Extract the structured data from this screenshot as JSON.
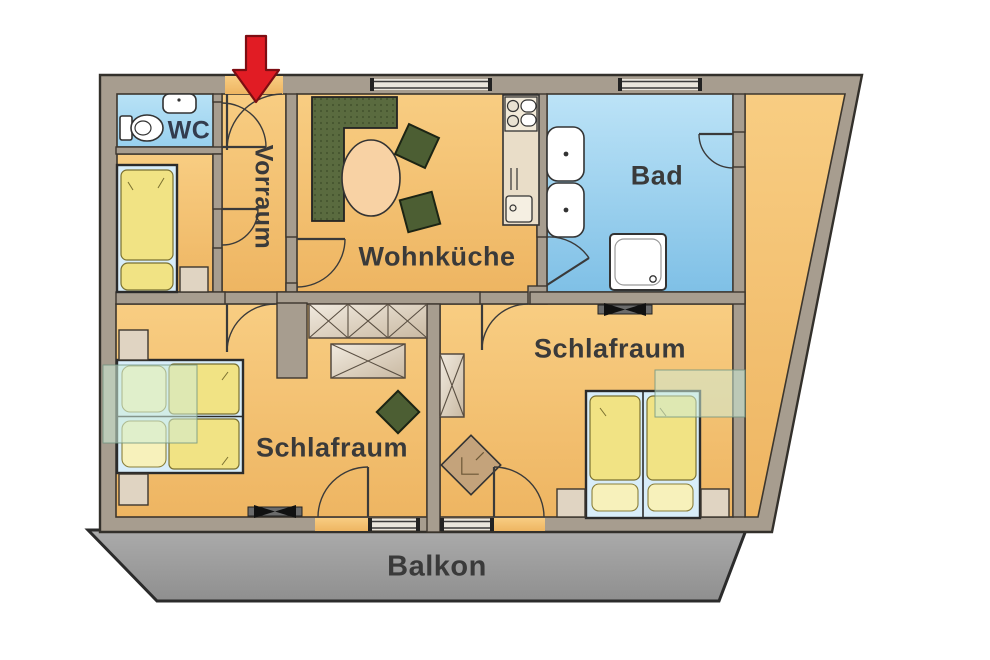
{
  "plan": {
    "type": "apartment-floor-plan",
    "rooms": [
      {
        "id": "wc",
        "label": "WC"
      },
      {
        "id": "vorraum",
        "label": "Vorraum",
        "label_rotation_deg": 90
      },
      {
        "id": "wohnkueche",
        "label": "Wohnküche"
      },
      {
        "id": "bad",
        "label": "Bad"
      },
      {
        "id": "schlafraum_right",
        "label": "Schlafraum"
      },
      {
        "id": "schlafraum_left",
        "label": "Schlafraum"
      },
      {
        "id": "balkon",
        "label": "Balkon"
      }
    ],
    "entrance": {
      "marker": "red-arrow",
      "direction": "down"
    },
    "furniture": [
      "corner-bench",
      "dining-table",
      "chair",
      "chair",
      "kitchen-unit",
      "single-bed",
      "double-bed",
      "double-bed",
      "wardrobe-3x",
      "wardrobe-1x",
      "wardrobe-vertical",
      "armchair",
      "stool",
      "toilet",
      "wc-sink",
      "washbasin",
      "washbasin",
      "shower",
      "radiator",
      "radiator",
      "nightstand",
      "nightstand",
      "nightstand",
      "nightstand",
      "nightstand"
    ],
    "colors": {
      "floor": "#f5c474",
      "wet_room": "#a5d7f2",
      "balcony": "#9c9c9c",
      "wall": "#a79d8f",
      "bench_green": "#5a6b3f",
      "bedding_yellow": "#f1e384",
      "entrance_arrow": "#e11c24",
      "label_text": "#3a3a3a",
      "wc_text": "#333c4e"
    }
  }
}
